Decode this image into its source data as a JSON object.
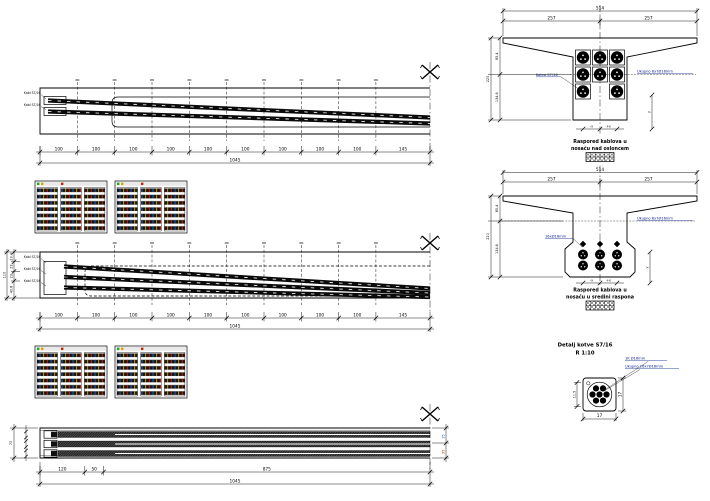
{
  "colors": {
    "line": "#000000",
    "label_blue": "#001a8c",
    "fleck_red": "#cc2200",
    "fleck_blue": "#2266cc",
    "fleck_yellow": "#d4a500"
  },
  "elevation_support": {
    "cable_leaders": [
      "Kabl S7/16",
      "Kabl S7/16"
    ],
    "dims": {
      "segments": [
        "100",
        "100",
        "100",
        "100",
        "100",
        "100",
        "100",
        "100",
        "100",
        "145"
      ],
      "total": "1045"
    }
  },
  "elevation_midspan": {
    "cable_leaders": [
      "Kabl S7/16",
      "Kabl S7/16",
      "Kabl S7/16"
    ],
    "left_dims": {
      "segments": [
        "23.4",
        "23",
        "23",
        "40.8"
      ],
      "total": "110"
    },
    "dims": {
      "segments": [
        "100",
        "100",
        "100",
        "100",
        "100",
        "100",
        "100",
        "100",
        "100",
        "145"
      ],
      "total": "1045"
    }
  },
  "plan": {
    "dims": {
      "segments": [
        "120",
        "50",
        "875"
      ],
      "total": "1045"
    },
    "left_total": "70",
    "right_segments": [
      "35",
      "35"
    ]
  },
  "section_support": {
    "top_dims": {
      "total": "514",
      "left": "257",
      "right": "257"
    },
    "left_dims": {
      "upper": "85.4",
      "lower": "134.6",
      "total": "220"
    },
    "anchor_label": "Kotva S7/16",
    "total_label": "Ukupno 8x7Ø16mm",
    "axis": {
      "neg": "-x",
      "pos": "+x",
      "y": "y"
    },
    "caption": [
      "Raspored kablova u",
      "nosaču nad osloncem"
    ],
    "dots": "· · ·"
  },
  "section_midspan": {
    "top_dims": {
      "total": "514",
      "left": "257",
      "right": "257"
    },
    "left_dims": {
      "upper": "85.4",
      "lower": "134.6",
      "total": "220"
    },
    "duct_label": "16xØ16mm",
    "total_label": "Ukupno 8x7Ø16mm",
    "axis": {
      "neg": "-x",
      "pos": "+x",
      "y": "y"
    },
    "caption": [
      "Raspored kablova u",
      "nosaču u sredini raspona"
    ]
  },
  "anchor_detail": {
    "title": "Detalj kotve S7/16",
    "scale": "R 1:10",
    "strand_label": "1K Ø16mm",
    "total_label": "Ukupno 16x7Ø16mm",
    "dims": {
      "width": "17",
      "height": "17",
      "left": "11.5"
    }
  }
}
